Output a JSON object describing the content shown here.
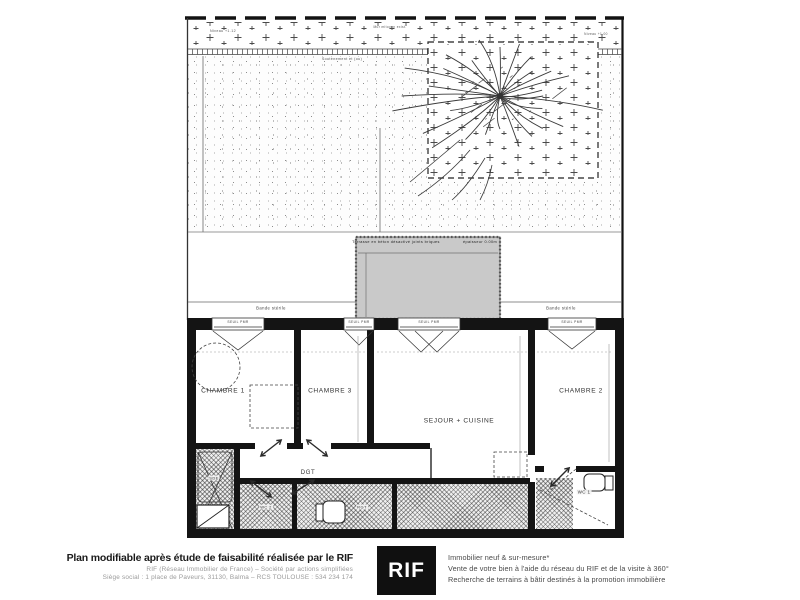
{
  "plan": {
    "annotations": {
      "niveau_left": "Niveau +1.12",
      "mur_mitoyen": "Mur mitoyen exist.",
      "niveau_right": "Niveau +1.00",
      "soutenement": "Soutènement et (ou)",
      "terrasse": "Terrasse en béton désactivé joints briques",
      "terrasse_note": "épaisseur 0.00m",
      "bande_sterile": "Bande stérile",
      "seuil_pmr": "SEUIL PMR"
    },
    "rooms": {
      "chambre1": "CHAMBRE 1",
      "chambre3": "CHAMBRE 3",
      "sejour": "SEJOUR + CUISINE",
      "chambre2": "CHAMBRE 2",
      "dgt": "DGT",
      "sde": "SDE",
      "wc2": "WC 2",
      "rgt": "RGT",
      "wc1": "WC 1"
    }
  },
  "footer": {
    "left": {
      "title": "Plan modifiable après étude de faisabilité réalisée par le RIF",
      "line1": "RIF (Réseau Immobilier de France)  –  Société par actions simplifiées",
      "line2": "Siège social : 1 place de Paveurs, 31130, Balma – RCS TOULOUSE : 534 234 174"
    },
    "logo": "RIF",
    "right": {
      "line1": "Immobilier neuf & sur-mesure*",
      "line2": "Vente de votre bien à l'aide du réseau du RIF et de la visite à 360°",
      "line3": "Recherche de terrains à bâtir destinés à la promotion immobilière"
    }
  },
  "colors": {
    "wall": "#141414",
    "terrace_fill": "#c9c9c9",
    "logo_bg": "#101010"
  }
}
